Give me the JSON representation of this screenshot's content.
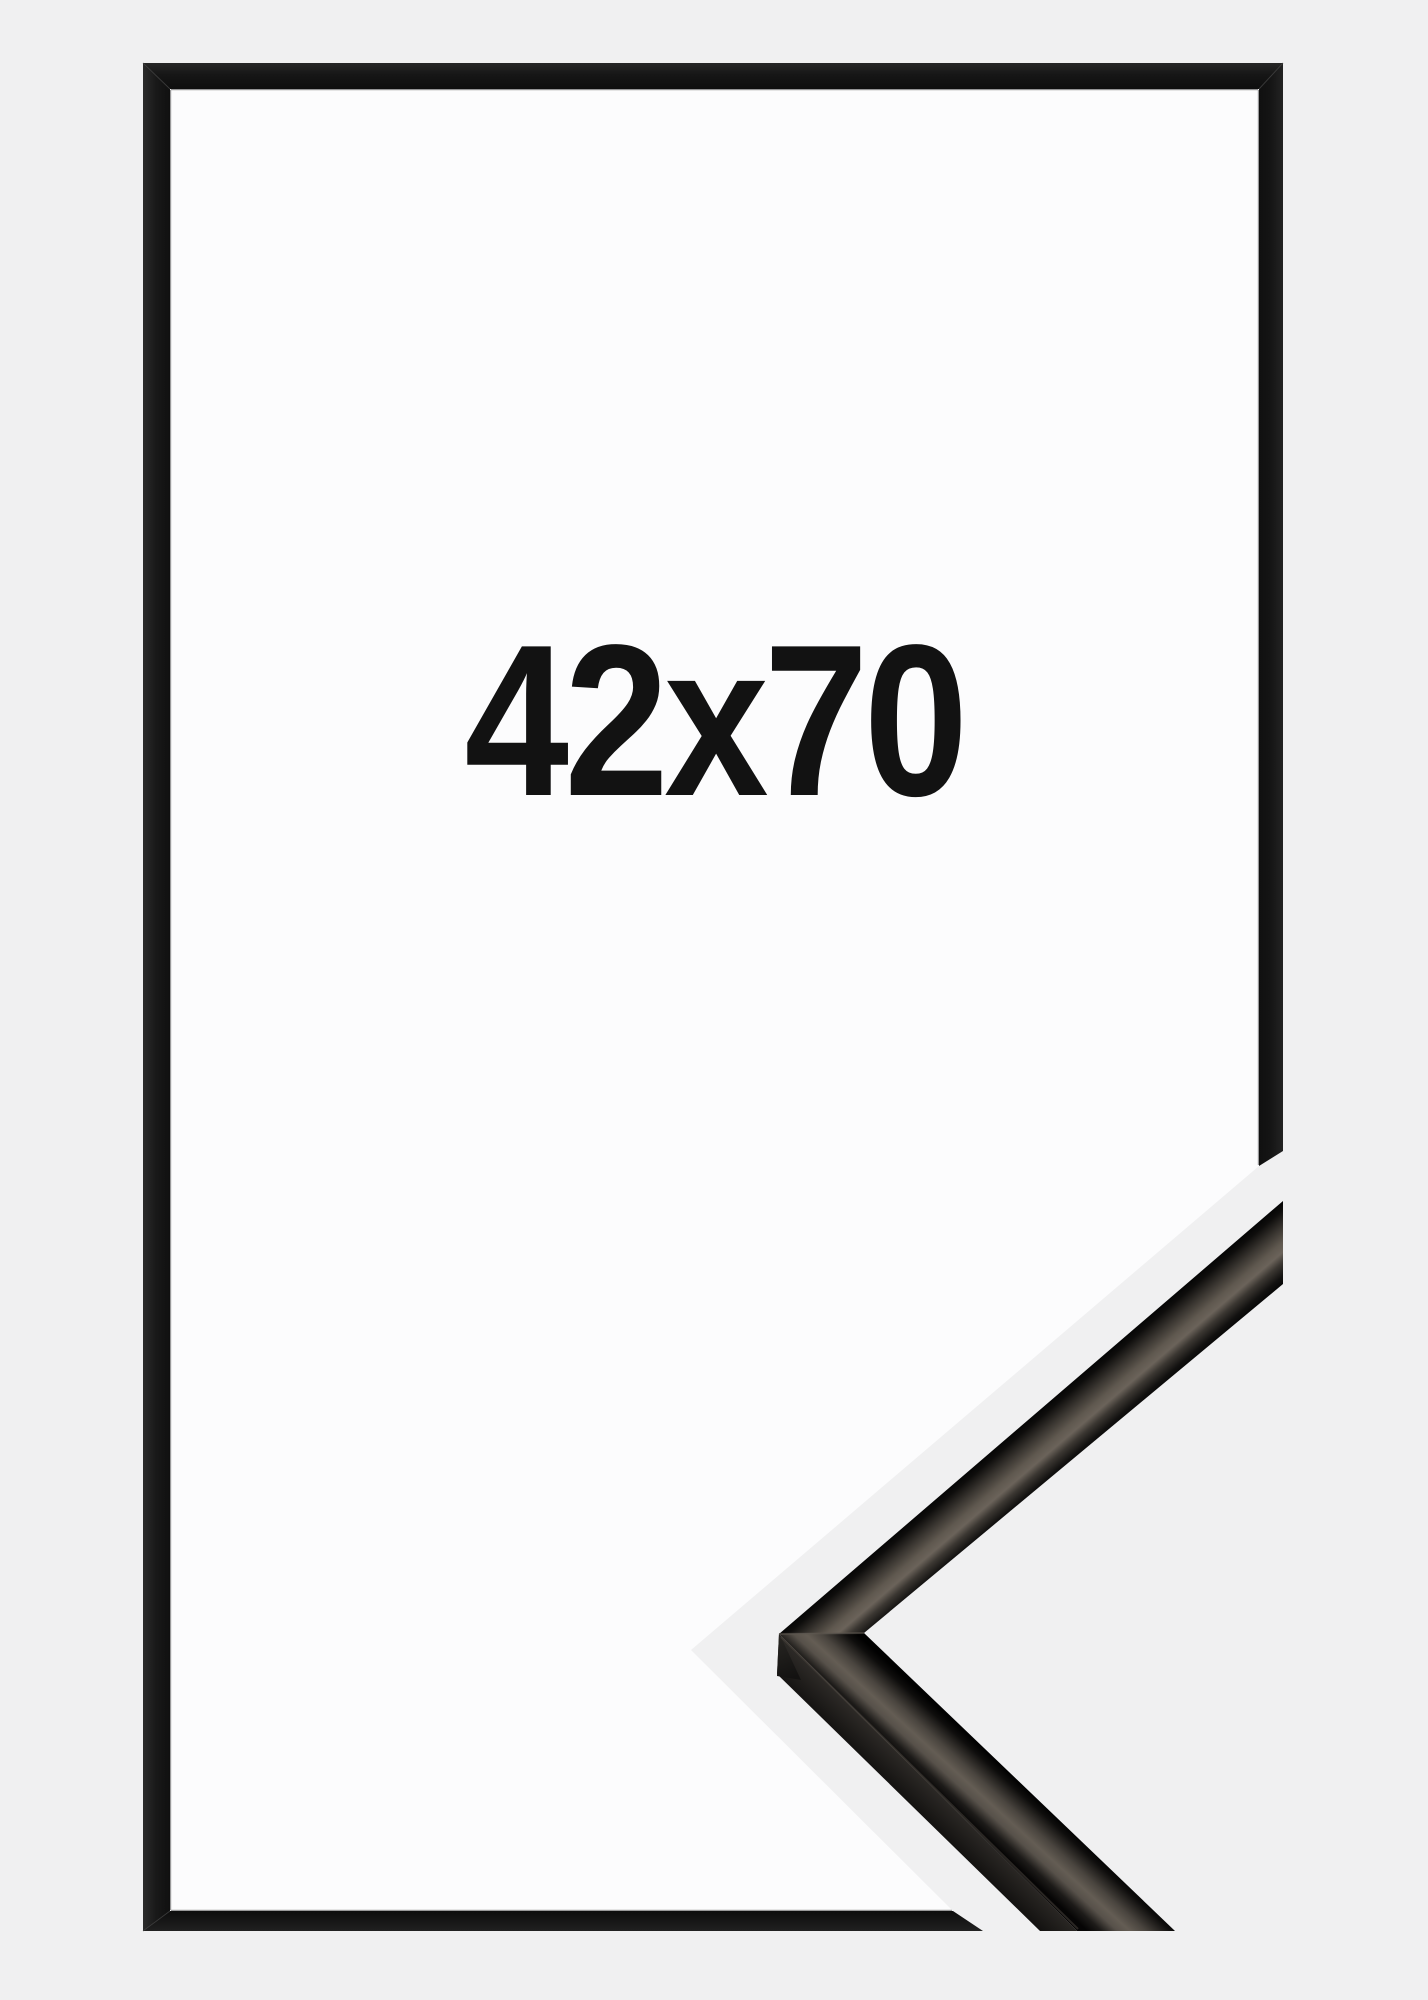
{
  "product_photo": {
    "size_label": "42x70",
    "frame": {
      "color_name": "black",
      "bar_color": "#161616",
      "profile_sheen_color": "#645d54"
    },
    "colors": {
      "background": "#f0f0f1",
      "inside_paper": "#fcfcfd",
      "label_text": "#121212"
    }
  }
}
